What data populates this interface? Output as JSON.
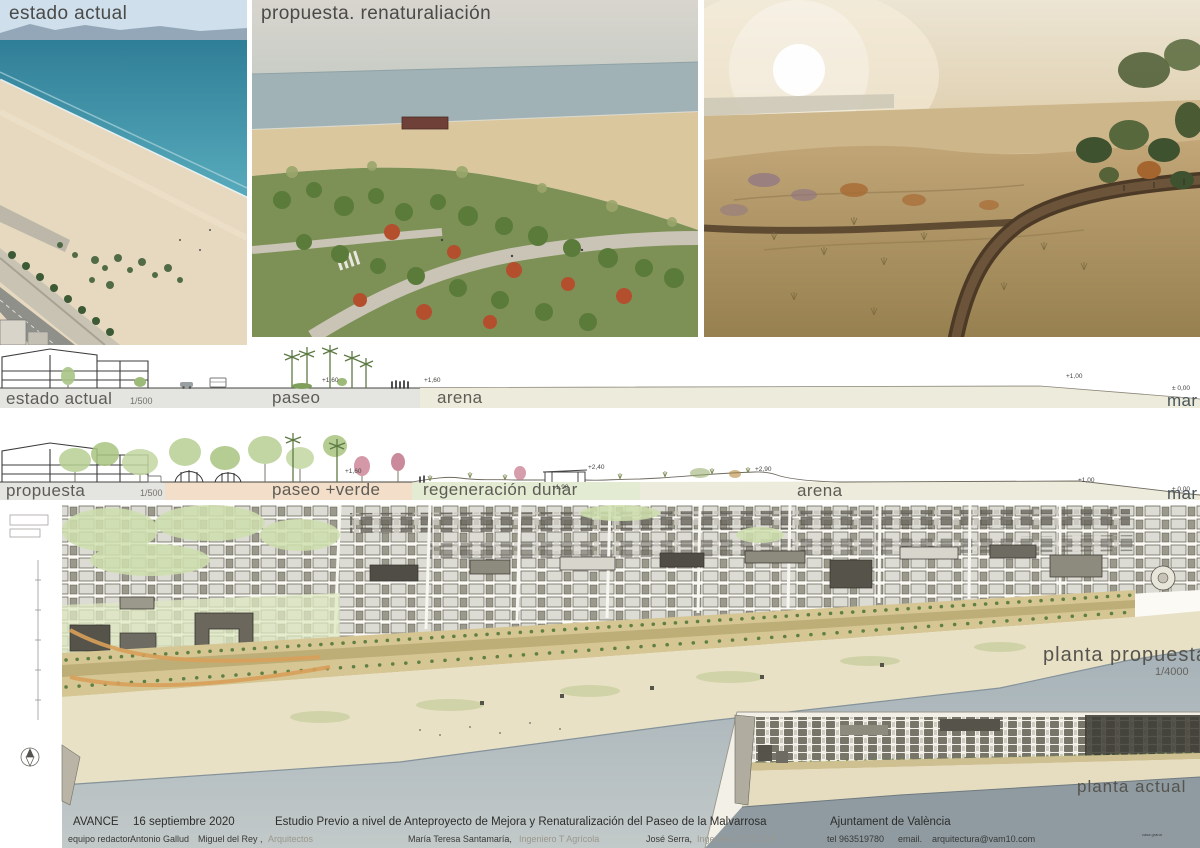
{
  "images": [
    {
      "title": "estado actual"
    },
    {
      "title": "propuesta. renaturaliación"
    }
  ],
  "sections": {
    "current": {
      "label": "estado actual",
      "scale": "1/500",
      "paseo": "paseo",
      "arena": "arena",
      "mar": "mar",
      "e1": "+1,60",
      "e2": "+1,60",
      "e3": "+1,00",
      "e4": "± 0,00"
    },
    "proposal": {
      "label": "propuesta",
      "scale": "1/500",
      "paseo": "paseo +verde",
      "regen": "regeneración dunar",
      "arena": "arena",
      "mar": "mar",
      "e1": "+1,60",
      "e2": "+1,90",
      "e3": "+2,40",
      "e4": "+2,90",
      "e5": "+1,00",
      "e6": "± 0,00"
    }
  },
  "plans": {
    "proposed": {
      "label": "planta propuesta",
      "scale": "1/4000"
    },
    "current": {
      "label": "planta actual",
      "micro": "casa grana"
    }
  },
  "footer": {
    "phase": "AVANCE",
    "date": "16 septiembre 2020",
    "title": "Estudio Previo a nivel de Anteproyecto de Mejora y Renaturalización del Paseo de la Malvarrosa",
    "client": "Ajuntament de València",
    "team_label": "equipo redactor.",
    "team": [
      {
        "name": "Antonio Gallud",
        "role": ""
      },
      {
        "name": "Miguel del Rey ,",
        "role": "Arquitectos"
      },
      {
        "name": "María Teresa Santamaría,",
        "role": "Ingeniero T Agrícola"
      },
      {
        "name": "José Serra,",
        "role": "Ingeniero T.S C.C.P"
      }
    ],
    "tel": "tel 963519780",
    "email_label": "email.",
    "email": "arquitectura@vam10.com"
  },
  "colors": {
    "sea_plan": "#aeb9be",
    "sea_inset": "#8f9ba1",
    "beach": "#e9e1c6",
    "band_gray": "#e4e4e1",
    "band_arena": "#edebdb",
    "band_peach": "#f3dfc9",
    "band_green": "#e3ebd2",
    "title_text": "#4a4a48"
  }
}
